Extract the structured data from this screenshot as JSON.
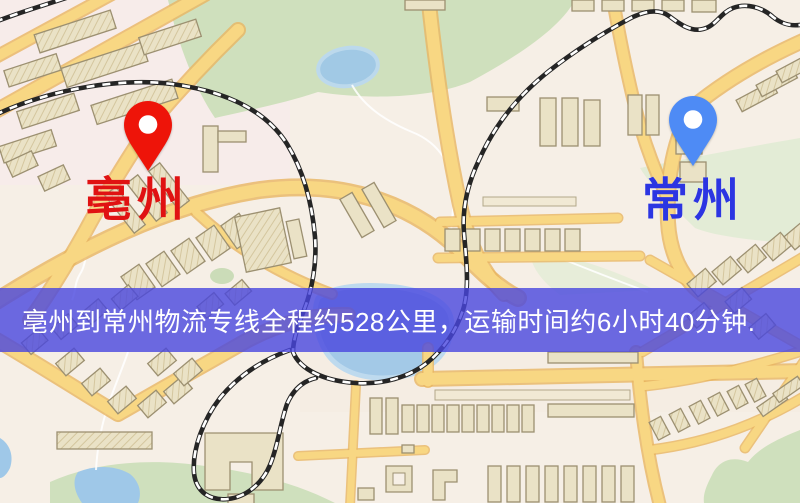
{
  "map": {
    "origin": {
      "label": "亳州",
      "pin_icon": "map-pin",
      "pin_color": "#ee1409",
      "label_color": "#e01212"
    },
    "destination": {
      "label": "常州",
      "pin_icon": "map-pin",
      "pin_color": "#4e8bf5",
      "label_color": "#2c35e2"
    },
    "palette": {
      "map_background": "#f6efe6",
      "road_yellow": "#f8d783",
      "road_border": "#e9b561",
      "park_green": "#cfe0bd",
      "water_blue": "#9fc8e8",
      "building_tan": "#eae2c6",
      "railway_black": "#252525"
    }
  },
  "banner": {
    "text": "亳州到常州物流专线全程约528公里，运输时间约6小时40分钟.",
    "distance_km": "528",
    "duration": "6小时40分钟",
    "background_color": "#4846df",
    "text_color": "#ffffff"
  }
}
